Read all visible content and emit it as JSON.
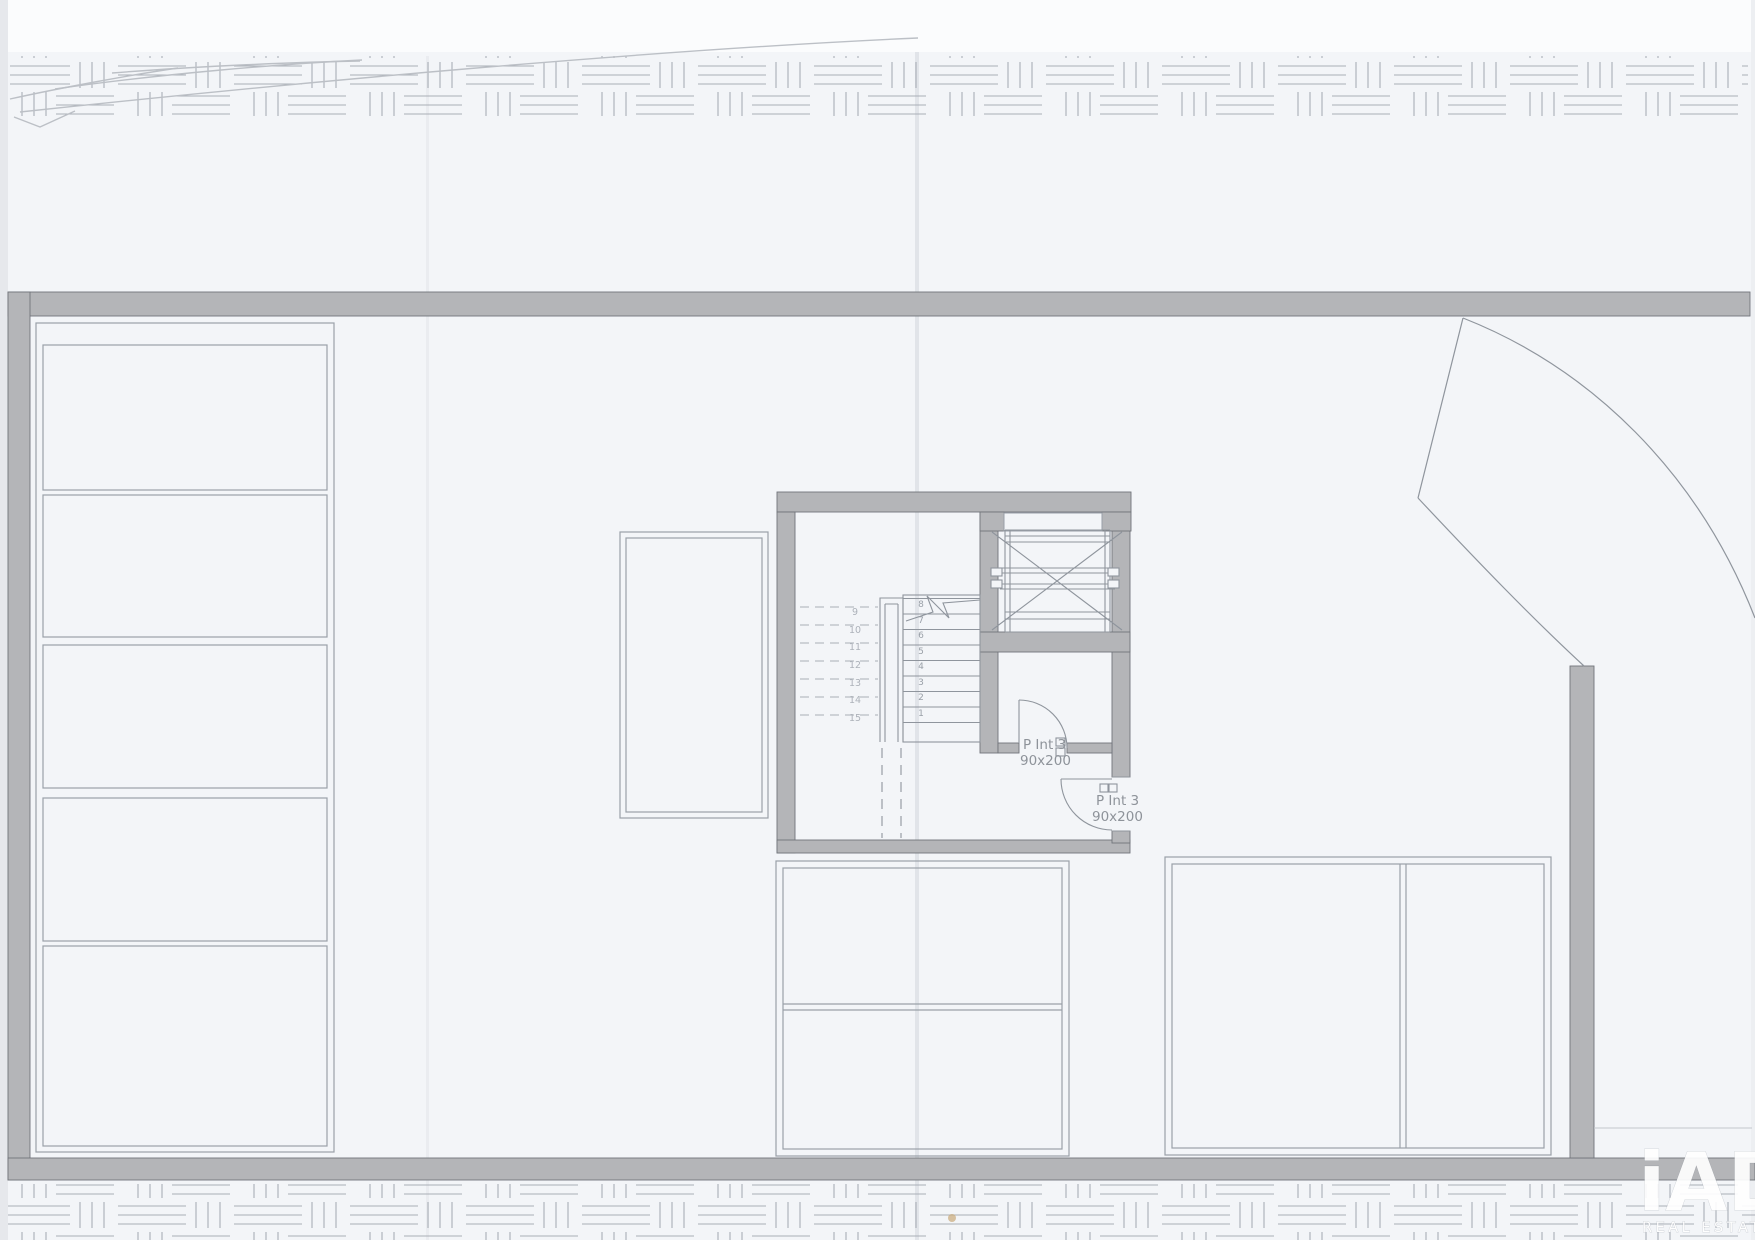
{
  "plan": {
    "doors": [
      {
        "name": "P Int 3",
        "size": "90x200"
      },
      {
        "name": "P Int 3",
        "size": "90x200"
      }
    ],
    "stairs": {
      "up_numbers": [
        "1",
        "2",
        "3",
        "4",
        "5",
        "6",
        "7",
        "8"
      ],
      "down_numbers": [
        "9",
        "10",
        "11",
        "12",
        "13",
        "14",
        "15"
      ]
    },
    "watermark": {
      "brand": "iAD",
      "tagline": "REAL ESTATE"
    }
  },
  "colors": {
    "paper": "#f3f5f8",
    "paper_top": "#fbfcfd",
    "wall_fill": "#b4b5b8",
    "wall_edge": "#70747a",
    "line": "#8f959d",
    "line_soft": "#a9aeb6",
    "text": "#8e939a",
    "pencil": "#bcc0c6",
    "watermark": "#ffffff",
    "speck": "#c9a979"
  }
}
